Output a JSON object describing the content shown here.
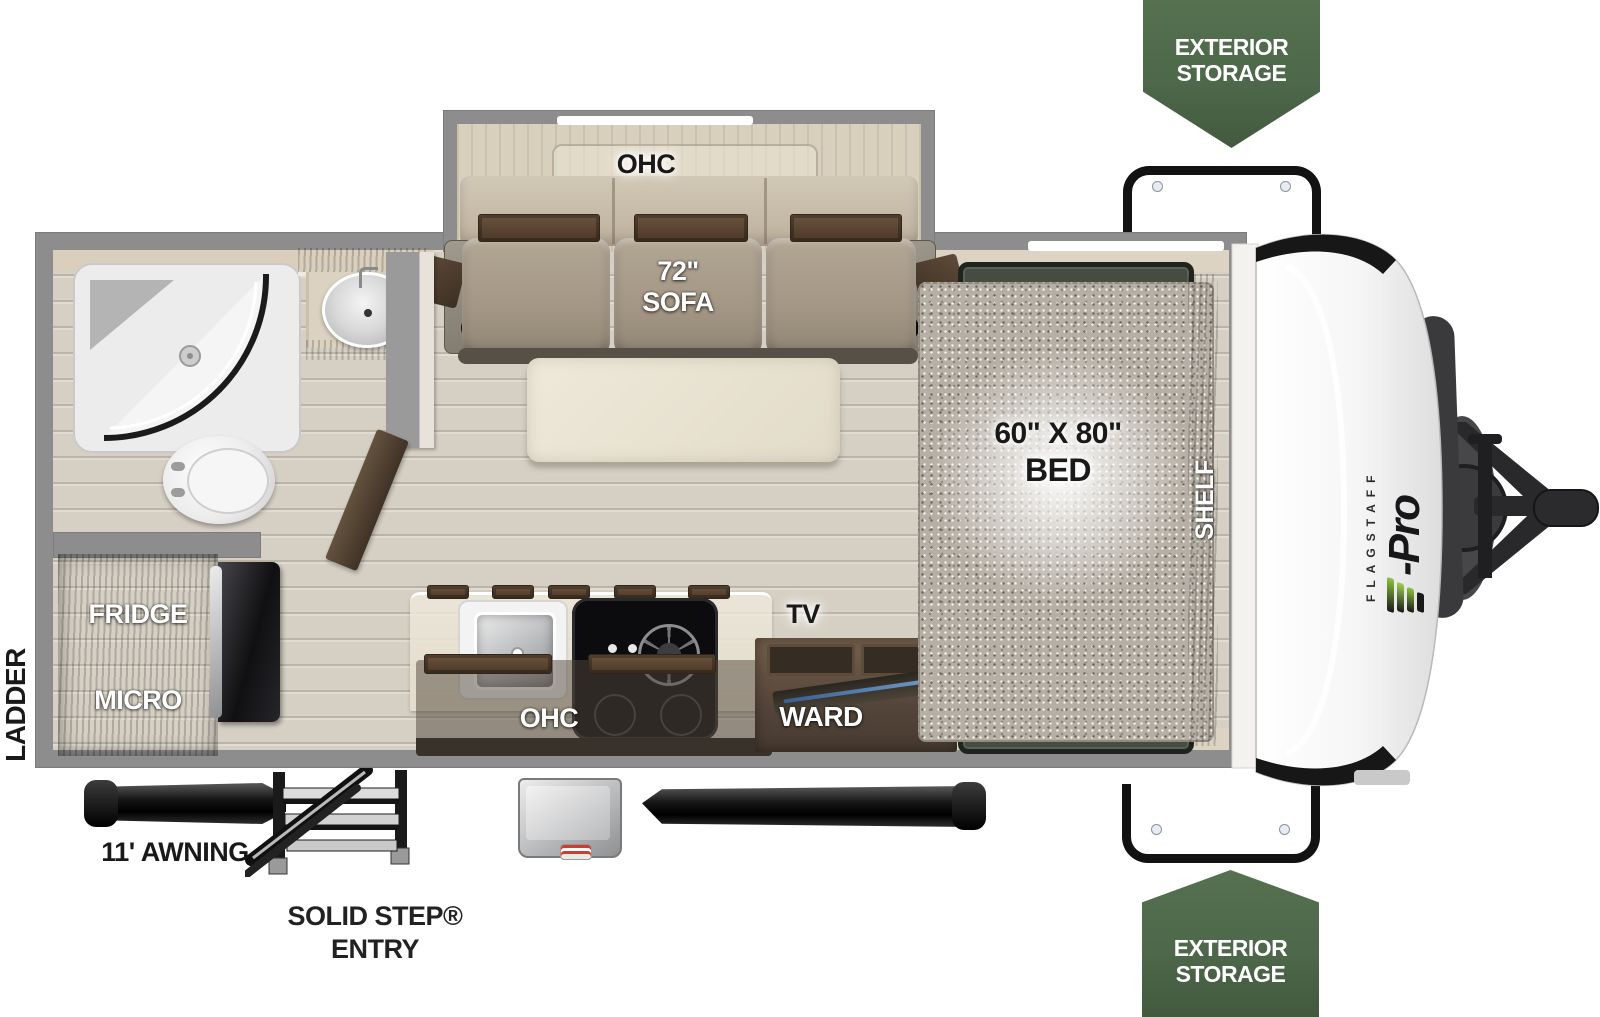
{
  "badge_top": {
    "line1": "EXTERIOR",
    "line2": "STORAGE"
  },
  "badge_bottom": {
    "line1": "EXTERIOR",
    "line2": "STORAGE"
  },
  "plan": {
    "living": {
      "ohc_label": "OHC",
      "sofa_size": "72\"",
      "sofa_label": "SOFA"
    },
    "bedroom": {
      "bed_size": "60\" X 80\"",
      "bed_label": "BED",
      "shelf_label": "SHELF"
    },
    "kitchen": {
      "ohc_label": "OHC",
      "tv_label": "TV",
      "ward_label": "WARD"
    },
    "appliances": {
      "fridge_label": "FRIDGE",
      "micro_label": "MICRO"
    }
  },
  "exterior": {
    "ladder_label": "LADDER",
    "awning_label": "11' AWNING",
    "step_label": "SOLID STEP®",
    "entry_label": "ENTRY"
  },
  "brand": {
    "name": "FLAGSTAFF",
    "model": "E-Pro",
    "model_suffix": "-Pro",
    "accent_green": "#8bc53f",
    "badge_green": "#4d684a"
  }
}
